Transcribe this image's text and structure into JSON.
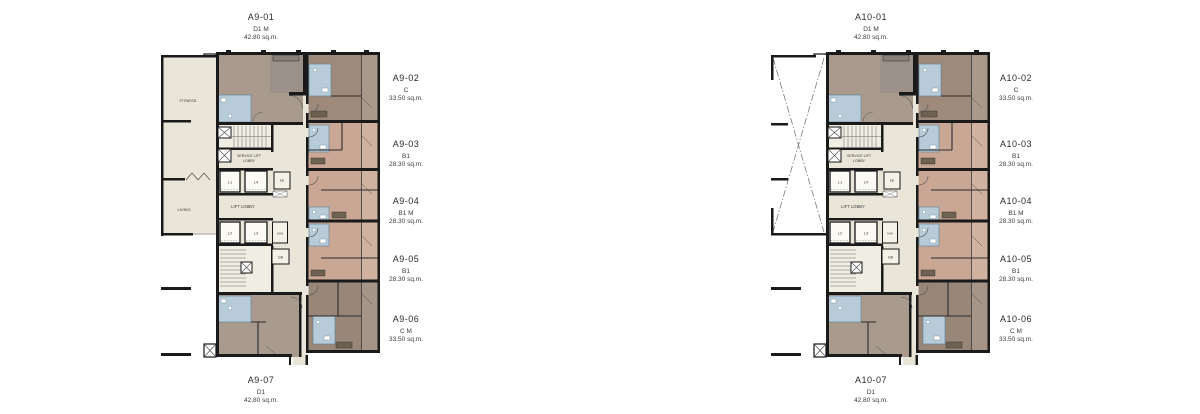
{
  "colors": {
    "background": "#ffffff",
    "common_area": "#e9e5d8",
    "stair_area": "#f0ede2",
    "unit_taupe": "#a89a8c",
    "unit_taupe_dark": "#9b9188",
    "unit_brown": "#9d8a7a",
    "unit_pink": "#c9a794",
    "unit_dark_brown": "#988678",
    "bathroom_blue": "#b7ccd8",
    "wall": "#1a1a1a"
  },
  "core_labels": {
    "service_lift_line1": "SERVICE LIFT",
    "service_lift_line2": "LOBBY",
    "lift_lobby": "LIFT LOBBY",
    "l1": "L1",
    "l2": "L2",
    "l3": "L3",
    "l4": "L4",
    "fe": "FE",
    "san": "SAN",
    "gb": "GB"
  },
  "plans": [
    {
      "name": "A9",
      "wing_labels": {
        "top": "FITNESS",
        "bottom": "LIVING"
      },
      "callouts": [
        {
          "unit": "A9-01",
          "type": "D1 M",
          "area": "42.80 sq.m."
        },
        {
          "unit": "A9-02",
          "type": "C",
          "area": "33.50 sq.m."
        },
        {
          "unit": "A9-03",
          "type": "B1",
          "area": "28.30 sq.m."
        },
        {
          "unit": "A9-04",
          "type": "B1 M",
          "area": "28.30 sq.m."
        },
        {
          "unit": "A9-05",
          "type": "B1",
          "area": "28.30 sq.m."
        },
        {
          "unit": "A9-06",
          "type": "C M",
          "area": "33.50 sq.m."
        },
        {
          "unit": "A9-07",
          "type": "D1",
          "area": "42.80 sq.m."
        }
      ]
    },
    {
      "name": "A10",
      "callouts": [
        {
          "unit": "A10-01",
          "type": "D1 M",
          "area": "42.80 sq.m."
        },
        {
          "unit": "A10-02",
          "type": "C",
          "area": "33.50 sq.m."
        },
        {
          "unit": "A10-03",
          "type": "B1",
          "area": "28.30 sq.m."
        },
        {
          "unit": "A10-04",
          "type": "B1 M",
          "area": "28.30 sq.m."
        },
        {
          "unit": "A10-05",
          "type": "B1",
          "area": "28.30 sq.m."
        },
        {
          "unit": "A10-06",
          "type": "C M",
          "area": "33.50 sq.m."
        },
        {
          "unit": "A10-07",
          "type": "D1",
          "area": "42.80 sq.m."
        }
      ]
    }
  ]
}
